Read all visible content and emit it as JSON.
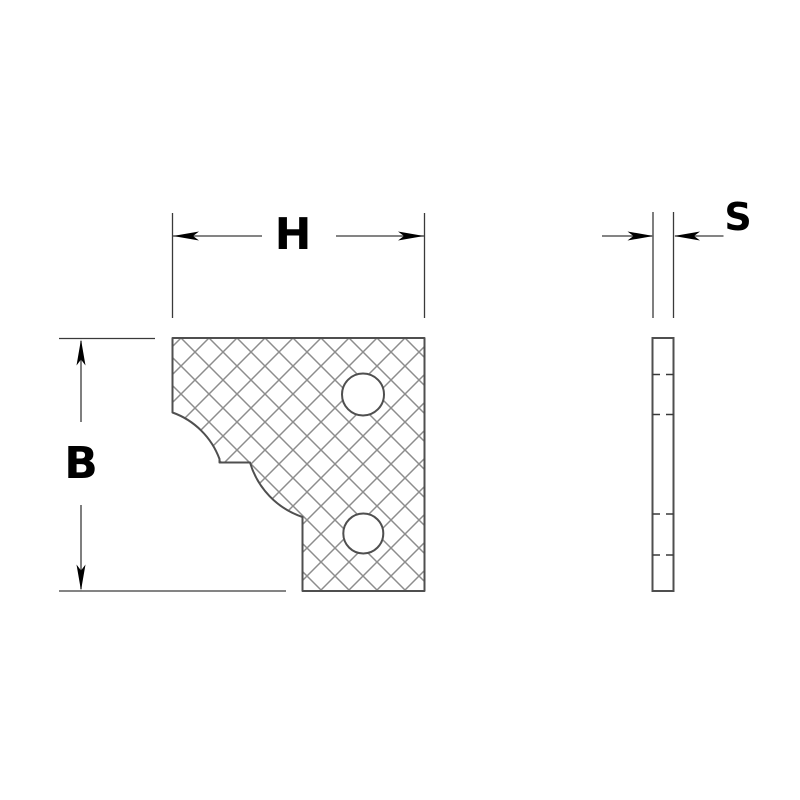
{
  "labels": {
    "h": "H",
    "b": "B",
    "s": "S"
  },
  "colors": {
    "background": "#ffffff",
    "line": "#3a3a3a",
    "outline": "#4f4f4f",
    "hatch": "#8d8d8d",
    "label": "#000000"
  }
}
